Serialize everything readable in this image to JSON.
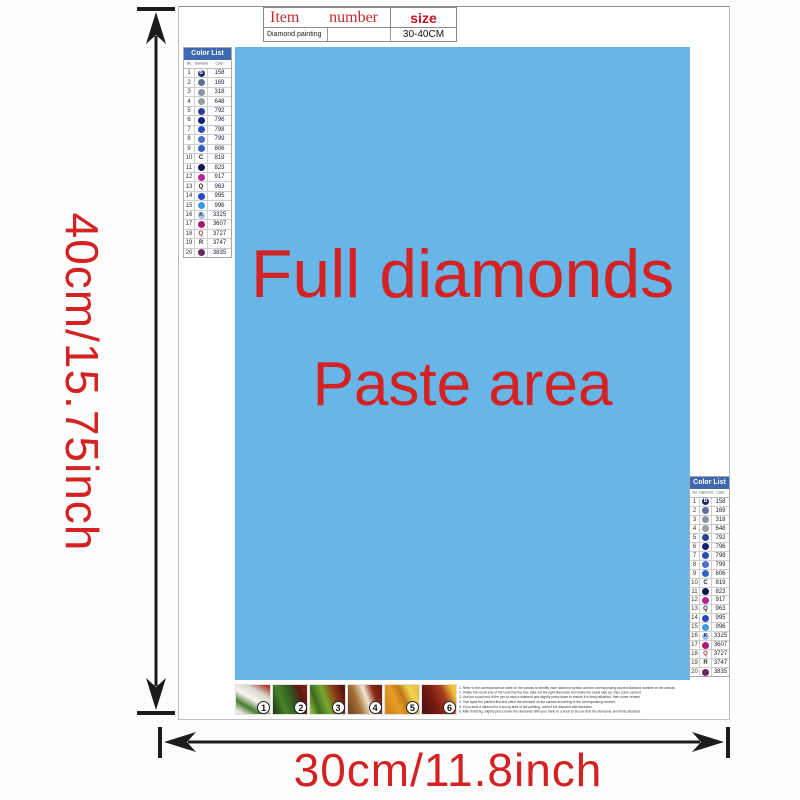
{
  "colors": {
    "accent_red": "#d42121",
    "header_red": "#c22a2e",
    "paste_blue": "#68b5e8",
    "list_header_blue": "#3e68b2",
    "arrow_black": "#1c1c1c"
  },
  "labels": {
    "vertical_dim": "40cm/15.75inch",
    "horizontal_dim": "30cm/11.8inch"
  },
  "item_table": {
    "col1_header": "Item",
    "col2_header": "number",
    "col3_header": "size",
    "row": {
      "item": "Diamond painting",
      "number": "",
      "size": "30-40CM"
    }
  },
  "paste_area": {
    "line1": "Full diamonds",
    "line2": "Paste area",
    "style": "background:#68b5e8"
  },
  "color_list": {
    "title": "Color List",
    "columns": [
      "No.",
      "Diamond",
      "Color"
    ],
    "rows": [
      {
        "no": "1",
        "symbol": "B",
        "type": "circle",
        "color": "#1b2a66",
        "letter_color": "#ffffff",
        "code": "158"
      },
      {
        "no": "2",
        "symbol": "",
        "type": "circle",
        "color": "#5f7090",
        "letter_color": "#ffffff",
        "code": "169"
      },
      {
        "no": "3",
        "symbol": "",
        "type": "circle",
        "color": "#8994a8",
        "letter_color": "#ffffff",
        "code": "318"
      },
      {
        "no": "4",
        "symbol": "",
        "type": "circle",
        "color": "#98a09c",
        "letter_color": "#ffffff",
        "code": "648"
      },
      {
        "no": "5",
        "symbol": "",
        "type": "circle",
        "color": "#2c3e96",
        "letter_color": "#ffffff",
        "code": "792"
      },
      {
        "no": "6",
        "symbol": "",
        "type": "circle",
        "color": "#131f70",
        "letter_color": "#ffffff",
        "code": "796"
      },
      {
        "no": "7",
        "symbol": "",
        "type": "circle",
        "color": "#2a4cb6",
        "letter_color": "#ffffff",
        "code": "798"
      },
      {
        "no": "8",
        "symbol": "",
        "type": "circle",
        "color": "#4a6ed0",
        "letter_color": "#ffffff",
        "code": "799"
      },
      {
        "no": "9",
        "symbol": "",
        "type": "circle",
        "color": "#2e64c0",
        "letter_color": "#ffffff",
        "code": "806"
      },
      {
        "no": "10",
        "symbol": "C",
        "type": "letter",
        "color": "#222222",
        "letter_color": "#222222",
        "code": "819"
      },
      {
        "no": "11",
        "symbol": "",
        "type": "circle",
        "color": "#0e1850",
        "letter_color": "#ffffff",
        "code": "823"
      },
      {
        "no": "12",
        "symbol": "",
        "type": "circle",
        "color": "#ba2090",
        "letter_color": "#ffffff",
        "code": "917"
      },
      {
        "no": "13",
        "symbol": "Q",
        "type": "letter",
        "color": "#222222",
        "letter_color": "#222222",
        "code": "963"
      },
      {
        "no": "14",
        "symbol": "",
        "type": "circle",
        "color": "#2746c2",
        "letter_color": "#ffffff",
        "code": "995"
      },
      {
        "no": "15",
        "symbol": "",
        "type": "circle",
        "color": "#3e9ade",
        "letter_color": "#ffffff",
        "code": "996"
      },
      {
        "no": "16",
        "symbol": "K",
        "type": "circle",
        "color": "#a2c2e6",
        "letter_color": "#223044",
        "code": "3325"
      },
      {
        "no": "17",
        "symbol": "",
        "type": "circle",
        "color": "#a81a74",
        "letter_color": "#ffffff",
        "code": "3607"
      },
      {
        "no": "18",
        "symbol": "Q",
        "type": "letter",
        "color": "#a83242",
        "letter_color": "#a83242",
        "code": "3727"
      },
      {
        "no": "19",
        "symbol": "R",
        "type": "letter",
        "color": "#333333",
        "letter_color": "#333333",
        "code": "3747"
      },
      {
        "no": "20",
        "symbol": "",
        "type": "circle",
        "color": "#6d2462",
        "letter_color": "#ffffff",
        "code": "3835"
      }
    ]
  },
  "steps": [
    {
      "num": "1",
      "style": "background:linear-gradient(210deg,#a8342c 5%,#d8d8cc 28%,#f6f5ef 50%,#4a7a33 72%,#eceade 92%)"
    },
    {
      "num": "2",
      "style": "background:linear-gradient(250deg,#7a1f16 8%,#5c1812 22%,#2e5c1e 45%,#49832b 70%,#1f4014 95%)"
    },
    {
      "num": "3",
      "style": "background:linear-gradient(250deg,#5a1410 10%,#8a3c16 30%,#77a833 55%,#3c6a1e 78%,#8fb63e 95%)"
    },
    {
      "num": "4",
      "style": "background:linear-gradient(250deg,#6e1c12 8%,#8a2c16 25%,#f0e6d2 45%,#a8743c 68%,#7c4a20 92%)"
    },
    {
      "num": "5",
      "style": "background:linear-gradient(245deg,#e8c244 10%,#f0d44e 25%,#c07818 45%,#e89c28 65%,#d4881c 88%)"
    },
    {
      "num": "6",
      "style": "background:linear-gradient(245deg,#f0c23c 12%,#a83c1e 35%,#7c1e16 60%,#5c1210 85%)"
    }
  ],
  "instructions": [
    "1. Refer to the correspondence table on the canvas to identify each diamond symbol and the corresponding colored diamond number on the canvas.",
    "2. Shake the round end of the tools into the box, take out the right diamonds and make the round side up, then some cement.",
    "3. Use the round end of the pen to stick a diamond and slightly press down to ensure it is firmly attached, then some cement.",
    "4. Tear apart the painted film and place the diamond on the canvas according to the corresponding number.",
    "5. If you stick a diamond in a wrong area of the painting, correct the diamond with tweezers.",
    "6. After finishing, slightly press down the diamonds with your hand or a book to ensure that the diamonds are firmly attached."
  ]
}
